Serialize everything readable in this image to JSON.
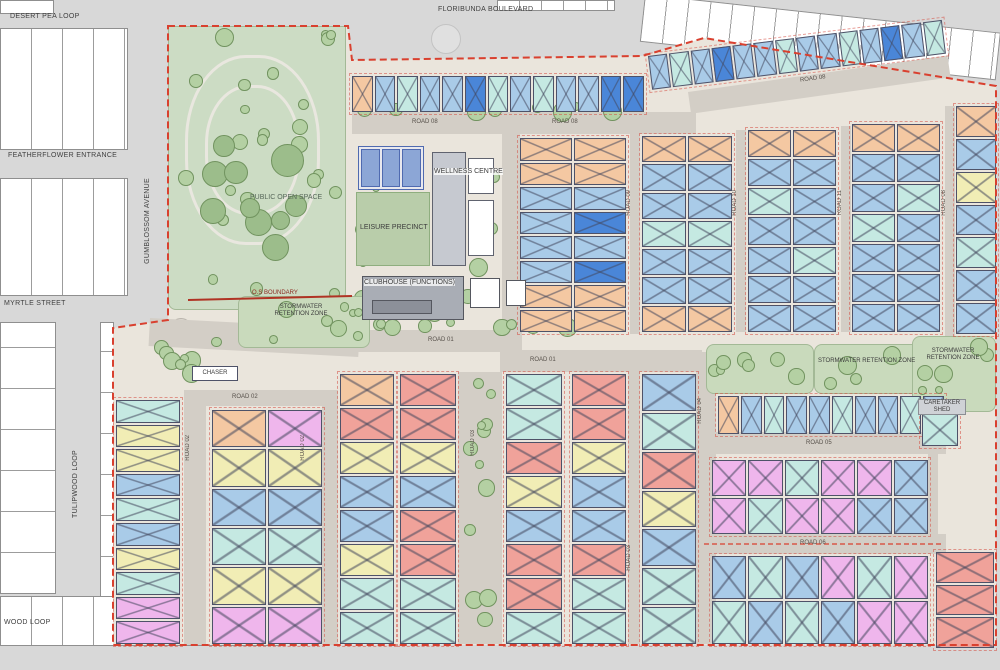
{
  "meta": {
    "title": "Residential estate masterplan site plan"
  },
  "palette": {
    "lb": "#a9cbe8",
    "cy": "#c5e9e2",
    "db": "#4a86d8",
    "or": "#f4c8a2",
    "sa": "#f0a29a",
    "ye": "#f1edb5",
    "mg": "#efb6ec",
    "road": "#d3cec6",
    "outer_road": "#d8d8d8",
    "ground": "#eae5dc",
    "park": "#ccdcc4",
    "tree": "#b4d0a3",
    "boundary": "#d9402f",
    "pool": "#8ca6d6"
  },
  "streets": [
    {
      "label": "DESERT PEA LOOP",
      "x": 10,
      "y": 13
    },
    {
      "label": "FLORIBUNDA BOULEVARD",
      "x": 438,
      "y": 6
    },
    {
      "label": "FEATHERFLOWER ENTRANCE",
      "x": 8,
      "y": 152
    },
    {
      "label": "GUMBLOSSOM AVENUE",
      "x": 144,
      "y": 178,
      "vert": true
    },
    {
      "label": "MYRTLE STREET",
      "x": 4,
      "y": 300
    },
    {
      "label": "TULIPWOOD LOOP",
      "x": 72,
      "y": 450,
      "vert": true
    },
    {
      "label": "WOOD LOOP",
      "x": 4,
      "y": 619
    }
  ],
  "road_labels": [
    {
      "label": "ROAD 08",
      "x": 412,
      "y": 119
    },
    {
      "label": "ROAD 08",
      "x": 552,
      "y": 119
    },
    {
      "label": "ROAD 08",
      "x": 800,
      "y": 76,
      "rot": -8
    },
    {
      "label": "ROAD 08",
      "x": 941,
      "y": 190,
      "vert": true
    },
    {
      "label": "ROAD 09",
      "x": 626,
      "y": 190,
      "vert": true
    },
    {
      "label": "ROAD 10",
      "x": 732,
      "y": 190,
      "vert": true
    },
    {
      "label": "ROAD 11",
      "x": 837,
      "y": 190,
      "vert": true
    },
    {
      "label": "ROAD 01",
      "x": 428,
      "y": 337
    },
    {
      "label": "ROAD 01",
      "x": 530,
      "y": 357
    },
    {
      "label": "ROAD 02",
      "x": 232,
      "y": 394
    },
    {
      "label": "ROAD 02",
      "x": 185,
      "y": 435,
      "vert": true
    },
    {
      "label": "ROAD 02",
      "x": 300,
      "y": 435,
      "vert": true
    },
    {
      "label": "ROAD 03",
      "x": 470,
      "y": 430,
      "vert": true
    },
    {
      "label": "ROAD 03",
      "x": 626,
      "y": 545,
      "vert": true
    },
    {
      "label": "ROAD 04",
      "x": 697,
      "y": 398,
      "vert": true
    },
    {
      "label": "ROAD 05",
      "x": 806,
      "y": 440
    },
    {
      "label": "ROAD 06",
      "x": 800,
      "y": 540
    }
  ],
  "facilities": {
    "public_open_space": "PUBLIC OPEN SPACE",
    "leisure_precinct": "LEISURE PRECINCT",
    "wellness_centre": "WELLNESS CENTRE",
    "clubhouse": "CLUBHOUSE (FUNCTIONS)",
    "os_boundary": "O.S BOUNDARY",
    "stormwater_full": "STORMWATER RETENTION ZONE",
    "stormwater_l1": "STORMWATER",
    "stormwater_l2": "RETENTION ZONE",
    "chaser": "CHASER",
    "caretaker_l1": "CARETAKER",
    "caretaker_l2": "SHED"
  },
  "geometry": {
    "roads": [
      [
        352,
        112,
        344,
        22,
        0
      ],
      [
        688,
        92,
        262,
        22,
        -8
      ],
      [
        502,
        130,
        18,
        204,
        0
      ],
      [
        630,
        134,
        10,
        200,
        0
      ],
      [
        736,
        130,
        10,
        202,
        0
      ],
      [
        841,
        126,
        10,
        206,
        0
      ],
      [
        945,
        106,
        10,
        230,
        0
      ],
      [
        350,
        330,
        172,
        22,
        0
      ],
      [
        500,
        350,
        202,
        22,
        0
      ],
      [
        500,
        332,
        20,
        40,
        0
      ],
      [
        150,
        318,
        210,
        28,
        3
      ],
      [
        184,
        390,
        22,
        255,
        0
      ],
      [
        322,
        390,
        16,
        255,
        0
      ],
      [
        184,
        390,
        140,
        16,
        0
      ],
      [
        458,
        372,
        44,
        272,
        0
      ],
      [
        628,
        372,
        12,
        272,
        0
      ],
      [
        696,
        352,
        20,
        292,
        0
      ],
      [
        714,
        432,
        232,
        22,
        0
      ],
      [
        700,
        534,
        246,
        20,
        0
      ],
      [
        928,
        452,
        10,
        86,
        0
      ]
    ],
    "green_zones": [
      {
        "x": 168,
        "y": 26,
        "w": 178,
        "h": 284,
        "bg": false,
        "trees": 24
      },
      {
        "x": 190,
        "y": 120,
        "w": 140,
        "h": 150,
        "bg": false,
        "trees": 10,
        "big": true
      },
      {
        "x": 348,
        "y": 130,
        "w": 166,
        "h": 200,
        "bg": false,
        "trees": 22
      },
      {
        "x": 238,
        "y": 296,
        "w": 132,
        "h": 52,
        "bg": true,
        "trees": 8
      },
      {
        "x": 150,
        "y": 330,
        "w": 92,
        "h": 58,
        "bg": false,
        "trees": 9
      },
      {
        "x": 352,
        "y": 100,
        "w": 340,
        "h": 12,
        "bg": false,
        "trees": 10
      },
      {
        "x": 352,
        "y": 316,
        "w": 340,
        "h": 13,
        "bg": false,
        "trees": 10
      },
      {
        "x": 706,
        "y": 344,
        "w": 108,
        "h": 50,
        "bg": true,
        "trees": 7
      },
      {
        "x": 814,
        "y": 344,
        "w": 134,
        "h": 50,
        "bg": true,
        "trees": 8
      },
      {
        "x": 912,
        "y": 336,
        "w": 84,
        "h": 76,
        "bg": true,
        "trees": 6
      },
      {
        "x": 460,
        "y": 376,
        "w": 40,
        "h": 266,
        "bg": false,
        "trees": 12
      }
    ],
    "blocks": [
      {
        "name": "top-row-west",
        "x": 352,
        "y": 76,
        "w": 292,
        "h": 36,
        "cols": 13,
        "cells": [
          "or",
          "lb",
          "cy",
          "lb",
          "lb",
          "db",
          "cy",
          "lb",
          "cy",
          "lb",
          "lb",
          "db",
          "db"
        ]
      },
      {
        "name": "top-row-east",
        "x": 648,
        "y": 56,
        "w": 296,
        "h": 34,
        "cols": 14,
        "rot": -7,
        "cells": [
          "lb",
          "cy",
          "lb",
          "db",
          "lb",
          "lb",
          "cy",
          "lb",
          "lb",
          "cy",
          "lb",
          "db",
          "lb",
          "cy"
        ]
      },
      {
        "name": "col-a",
        "x": 520,
        "y": 138,
        "w": 106,
        "h": 194,
        "cols": 2,
        "cells": [
          "or",
          "or",
          "or",
          "or",
          "lb",
          "lb",
          "lb",
          "db",
          "lb",
          "lb",
          "lb",
          "db",
          "or",
          "or",
          "or",
          "or"
        ]
      },
      {
        "name": "col-b",
        "x": 642,
        "y": 136,
        "w": 90,
        "h": 196,
        "cols": 2,
        "cells": [
          "or",
          "or",
          "lb",
          "lb",
          "lb",
          "lb",
          "cy",
          "cy",
          "lb",
          "lb",
          "lb",
          "lb",
          "or",
          "or"
        ]
      },
      {
        "name": "col-c",
        "x": 748,
        "y": 130,
        "w": 88,
        "h": 202,
        "cols": 2,
        "cells": [
          "or",
          "or",
          "lb",
          "lb",
          "cy",
          "lb",
          "lb",
          "lb",
          "lb",
          "cy",
          "lb",
          "lb",
          "lb",
          "lb"
        ]
      },
      {
        "name": "col-d",
        "x": 852,
        "y": 124,
        "w": 88,
        "h": 208,
        "cols": 2,
        "cells": [
          "or",
          "or",
          "lb",
          "lb",
          "lb",
          "cy",
          "cy",
          "lb",
          "lb",
          "lb",
          "lb",
          "lb",
          "lb",
          "lb"
        ]
      },
      {
        "name": "col-e",
        "x": 956,
        "y": 106,
        "w": 40,
        "h": 228,
        "cols": 1,
        "cells": [
          "or",
          "lb",
          "ye",
          "lb",
          "cy",
          "lb",
          "lb"
        ]
      },
      {
        "name": "west-col",
        "x": 116,
        "y": 400,
        "w": 64,
        "h": 244,
        "cols": 1,
        "cells": [
          "cy",
          "ye",
          "ye",
          "lb",
          "cy",
          "lb",
          "ye",
          "cy",
          "mg",
          "mg"
        ]
      },
      {
        "name": "block-l2",
        "x": 212,
        "y": 410,
        "w": 110,
        "h": 234,
        "cols": 2,
        "cells": [
          "or",
          "mg",
          "ye",
          "ye",
          "lb",
          "lb",
          "cy",
          "cy",
          "ye",
          "ye",
          "mg",
          "mg"
        ]
      },
      {
        "name": "col-p1",
        "x": 340,
        "y": 374,
        "w": 54,
        "h": 270,
        "cols": 1,
        "cells": [
          "or",
          "sa",
          "ye",
          "lb",
          "lb",
          "ye",
          "cy",
          "cy"
        ]
      },
      {
        "name": "col-p2",
        "x": 400,
        "y": 374,
        "w": 56,
        "h": 270,
        "cols": 1,
        "cells": [
          "sa",
          "sa",
          "ye",
          "lb",
          "sa",
          "sa",
          "cy",
          "cy"
        ]
      },
      {
        "name": "col-q1",
        "x": 506,
        "y": 374,
        "w": 56,
        "h": 270,
        "cols": 1,
        "cells": [
          "cy",
          "cy",
          "sa",
          "ye",
          "lb",
          "sa",
          "sa",
          "cy"
        ]
      },
      {
        "name": "col-q2",
        "x": 572,
        "y": 374,
        "w": 54,
        "h": 270,
        "cols": 1,
        "cells": [
          "sa",
          "sa",
          "ye",
          "lb",
          "lb",
          "sa",
          "cy",
          "cy"
        ]
      },
      {
        "name": "col-q3",
        "x": 642,
        "y": 374,
        "w": 54,
        "h": 270,
        "cols": 1,
        "cells": [
          "lb",
          "cy",
          "sa",
          "ye",
          "lb",
          "cy",
          "cy"
        ]
      },
      {
        "name": "row-r1",
        "x": 718,
        "y": 396,
        "w": 226,
        "h": 38,
        "cols": 10,
        "cells": [
          "or",
          "lb",
          "cy",
          "lb",
          "lb",
          "cy",
          "lb",
          "lb",
          "cy",
          "lb"
        ]
      },
      {
        "name": "grid-r2",
        "x": 712,
        "y": 460,
        "w": 216,
        "h": 74,
        "cols": 6,
        "cells": [
          "mg",
          "mg",
          "cy",
          "mg",
          "mg",
          "lb",
          "mg",
          "cy",
          "mg",
          "mg",
          "lb",
          "lb"
        ]
      },
      {
        "name": "grid-r3",
        "x": 712,
        "y": 556,
        "w": 216,
        "h": 88,
        "cols": 6,
        "cells": [
          "lb",
          "cy",
          "lb",
          "mg",
          "cy",
          "mg",
          "cy",
          "lb",
          "cy",
          "lb",
          "mg",
          "mg"
        ]
      },
      {
        "name": "col-r4",
        "x": 936,
        "y": 552,
        "w": 58,
        "h": 96,
        "cols": 1,
        "cells": [
          "sa",
          "sa",
          "sa"
        ]
      },
      {
        "name": "caretaker-shed-unit",
        "x": 922,
        "y": 414,
        "w": 36,
        "h": 32,
        "cols": 1,
        "cells": [
          "cy"
        ]
      }
    ]
  }
}
